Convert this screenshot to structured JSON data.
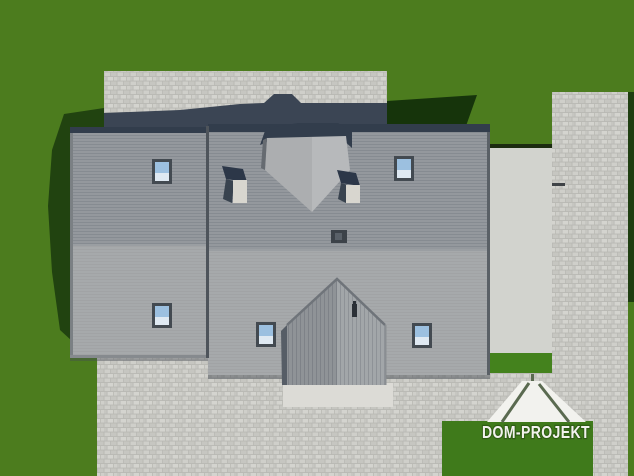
{
  "scene": {
    "description": "Aerial 3D architectural rendering of a house roof with skylights, paved yard and lawn",
    "logo": {
      "text": "DOM-PROJEKT"
    },
    "colors": {
      "grass": "#4c7c1e",
      "grass_shadow_left": "#214310",
      "grass_shadow_right": "#16340b",
      "grass_sliver_dark": "#1f3e10",
      "lawn_patch": "#44821d",
      "logo_green": "#3f7a1b",
      "paving_base": "#b9b9b4",
      "paving_stone_light": "#cfcfca",
      "paving_stone_mid": "#c6c6c1",
      "paving_stone_bright": "#d4d4cf",
      "paving_shadow": "#3b4554",
      "roof_eave_dark": "#323d4c",
      "roof_upper": "#94989d",
      "roof_lower": "#a6a9ab",
      "roof_ridge": "#9a9ea2",
      "roof_edge_line": "#5a6066",
      "roof_junction_line": "#4e545b",
      "dormer_face": "#b7b9bb",
      "dormer_edge": "#666b71",
      "gable_left_face": "#8f9397",
      "gable_right_face": "#a2a6a9",
      "gable_shadow": "#565d66",
      "chimney_cap": "#2c3748",
      "chimney_body": "#d8d6cf",
      "skylight_frame": "#434a51",
      "skylight_glass": "#9cc0e0",
      "skylight_glass_bottom": "#dfe9f2",
      "terrace": "#d2d3ce",
      "terrace_shadow_line": "#1c2b10",
      "porch": "#dcdbd6",
      "logo_white": "#f2f2ee",
      "logo_outline": "#2f5c15",
      "logo_line": "#5a6a50"
    }
  }
}
